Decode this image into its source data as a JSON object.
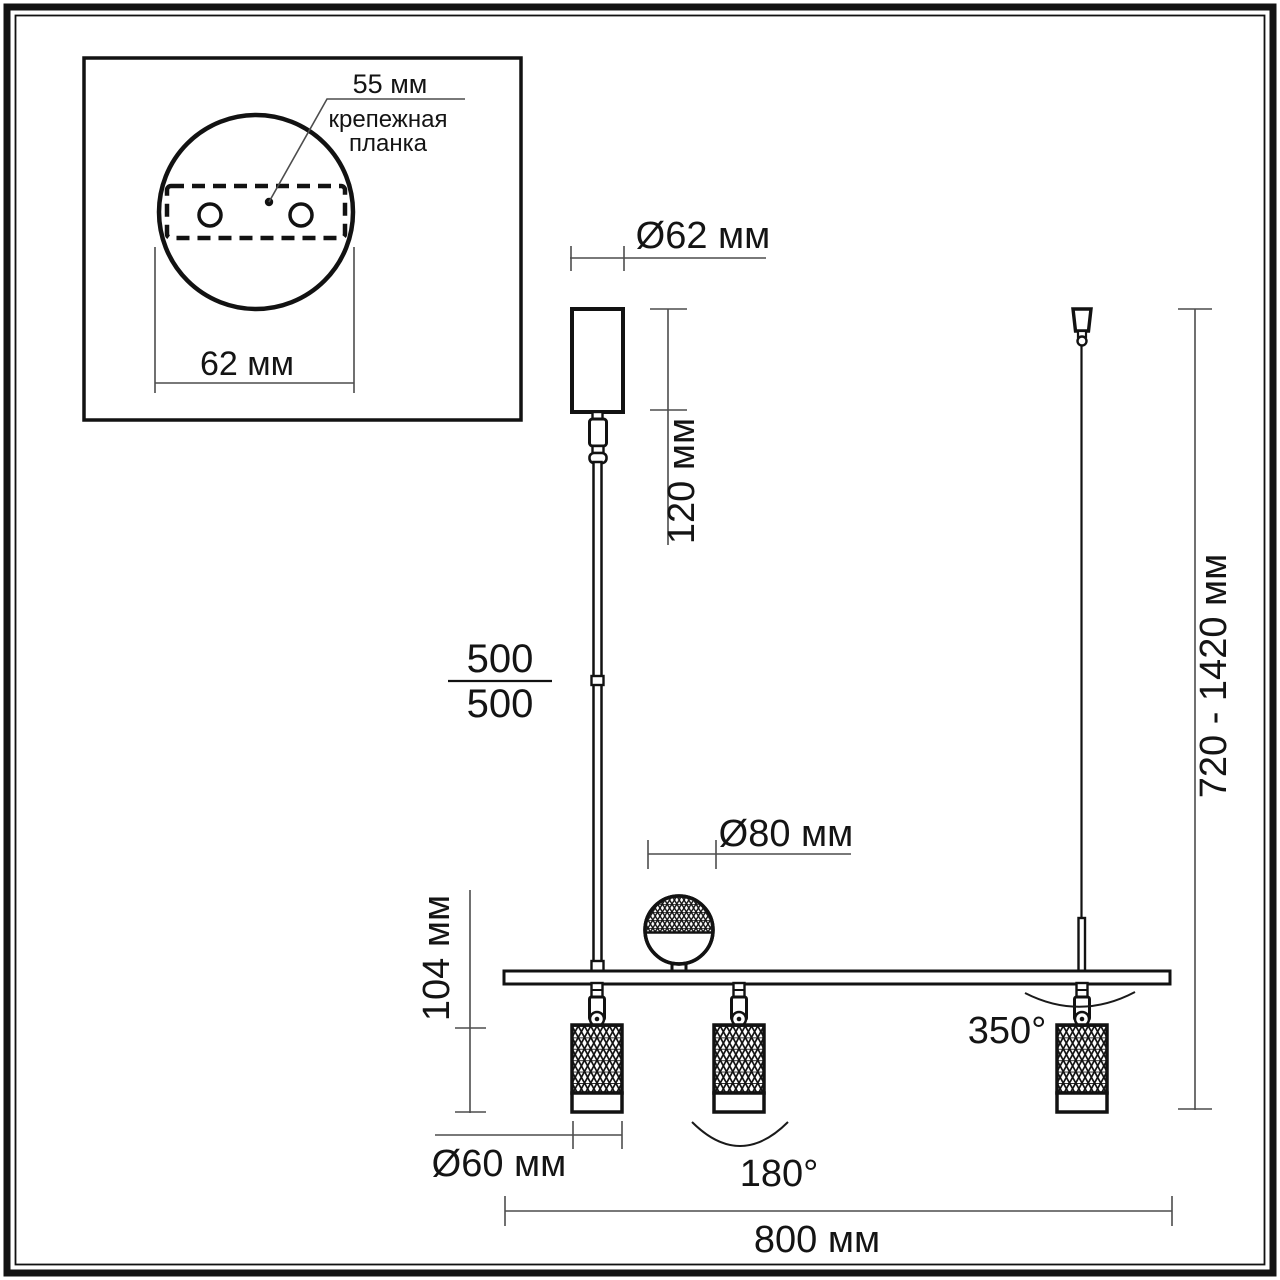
{
  "inset": {
    "hole_spacing": "55 мм",
    "plate_line1": "крепежная",
    "plate_line2": "планка",
    "base_width": "62 мм"
  },
  "dims": {
    "canopy_diameter": "Ø62 мм",
    "canopy_height": "120 мм",
    "rod_upper": "500",
    "rod_lower": "500",
    "sphere_diameter": "Ø80 мм",
    "spot_height": "104 мм",
    "spot_diameter": "Ø60 мм",
    "tilt_angle": "180°",
    "rotation_angle": "350°",
    "bar_length": "800 мм",
    "height_range": "720 - 1420 мм"
  }
}
